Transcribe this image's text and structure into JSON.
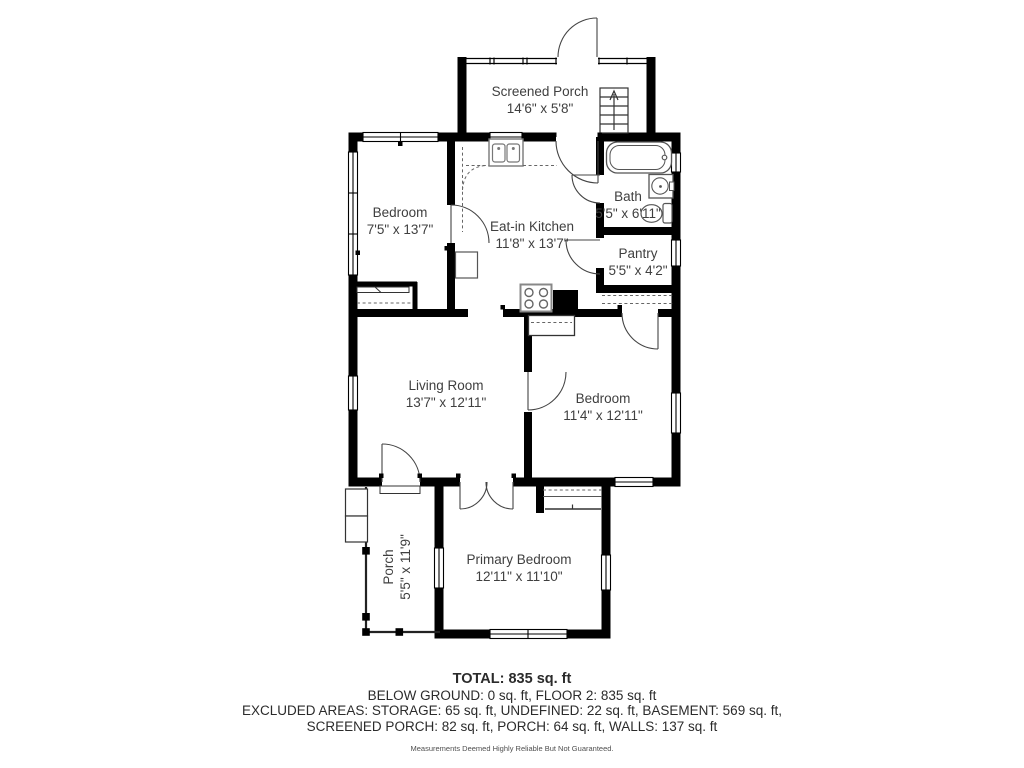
{
  "floor_plan": {
    "colors": {
      "wall_color": "#000000",
      "label_color": "#3f3f3f"
    },
    "rooms": [
      {
        "name": "Screened Porch",
        "dims": "14'6\" x 5'8\""
      },
      {
        "name": "Bedroom",
        "dims": "7'5\" x 13'7\""
      },
      {
        "name": "Eat-in Kitchen",
        "dims": "11'8\" x 13'7\""
      },
      {
        "name": "Bath",
        "dims": "5'5\" x 6'11\""
      },
      {
        "name": "Pantry",
        "dims": "5'5\" x 4'2\""
      },
      {
        "name": "Living Room",
        "dims": "13'7\" x 12'11\""
      },
      {
        "name": "Bedroom",
        "dims": "11'4\" x 12'11\""
      },
      {
        "name": "Primary Bedroom",
        "dims": "12'11\" x 11'10\""
      },
      {
        "name": "Porch",
        "dims": "5'5\" x 11'9\""
      }
    ],
    "summary": {
      "total": "TOTAL: 835 sq. ft",
      "below_ground_floor2": "BELOW GROUND: 0 sq. ft, FLOOR 2: 835 sq. ft",
      "excluded_line1": "EXCLUDED AREAS: STORAGE: 65 sq. ft, UNDEFINED: 22 sq. ft, BASEMENT: 569 sq. ft,",
      "excluded_line2": "SCREENED PORCH: 82 sq. ft, PORCH: 64 sq. ft, WALLS: 137 sq. ft",
      "disclaimer": "Measurements Deemed Highly Reliable But Not Guaranteed."
    }
  }
}
